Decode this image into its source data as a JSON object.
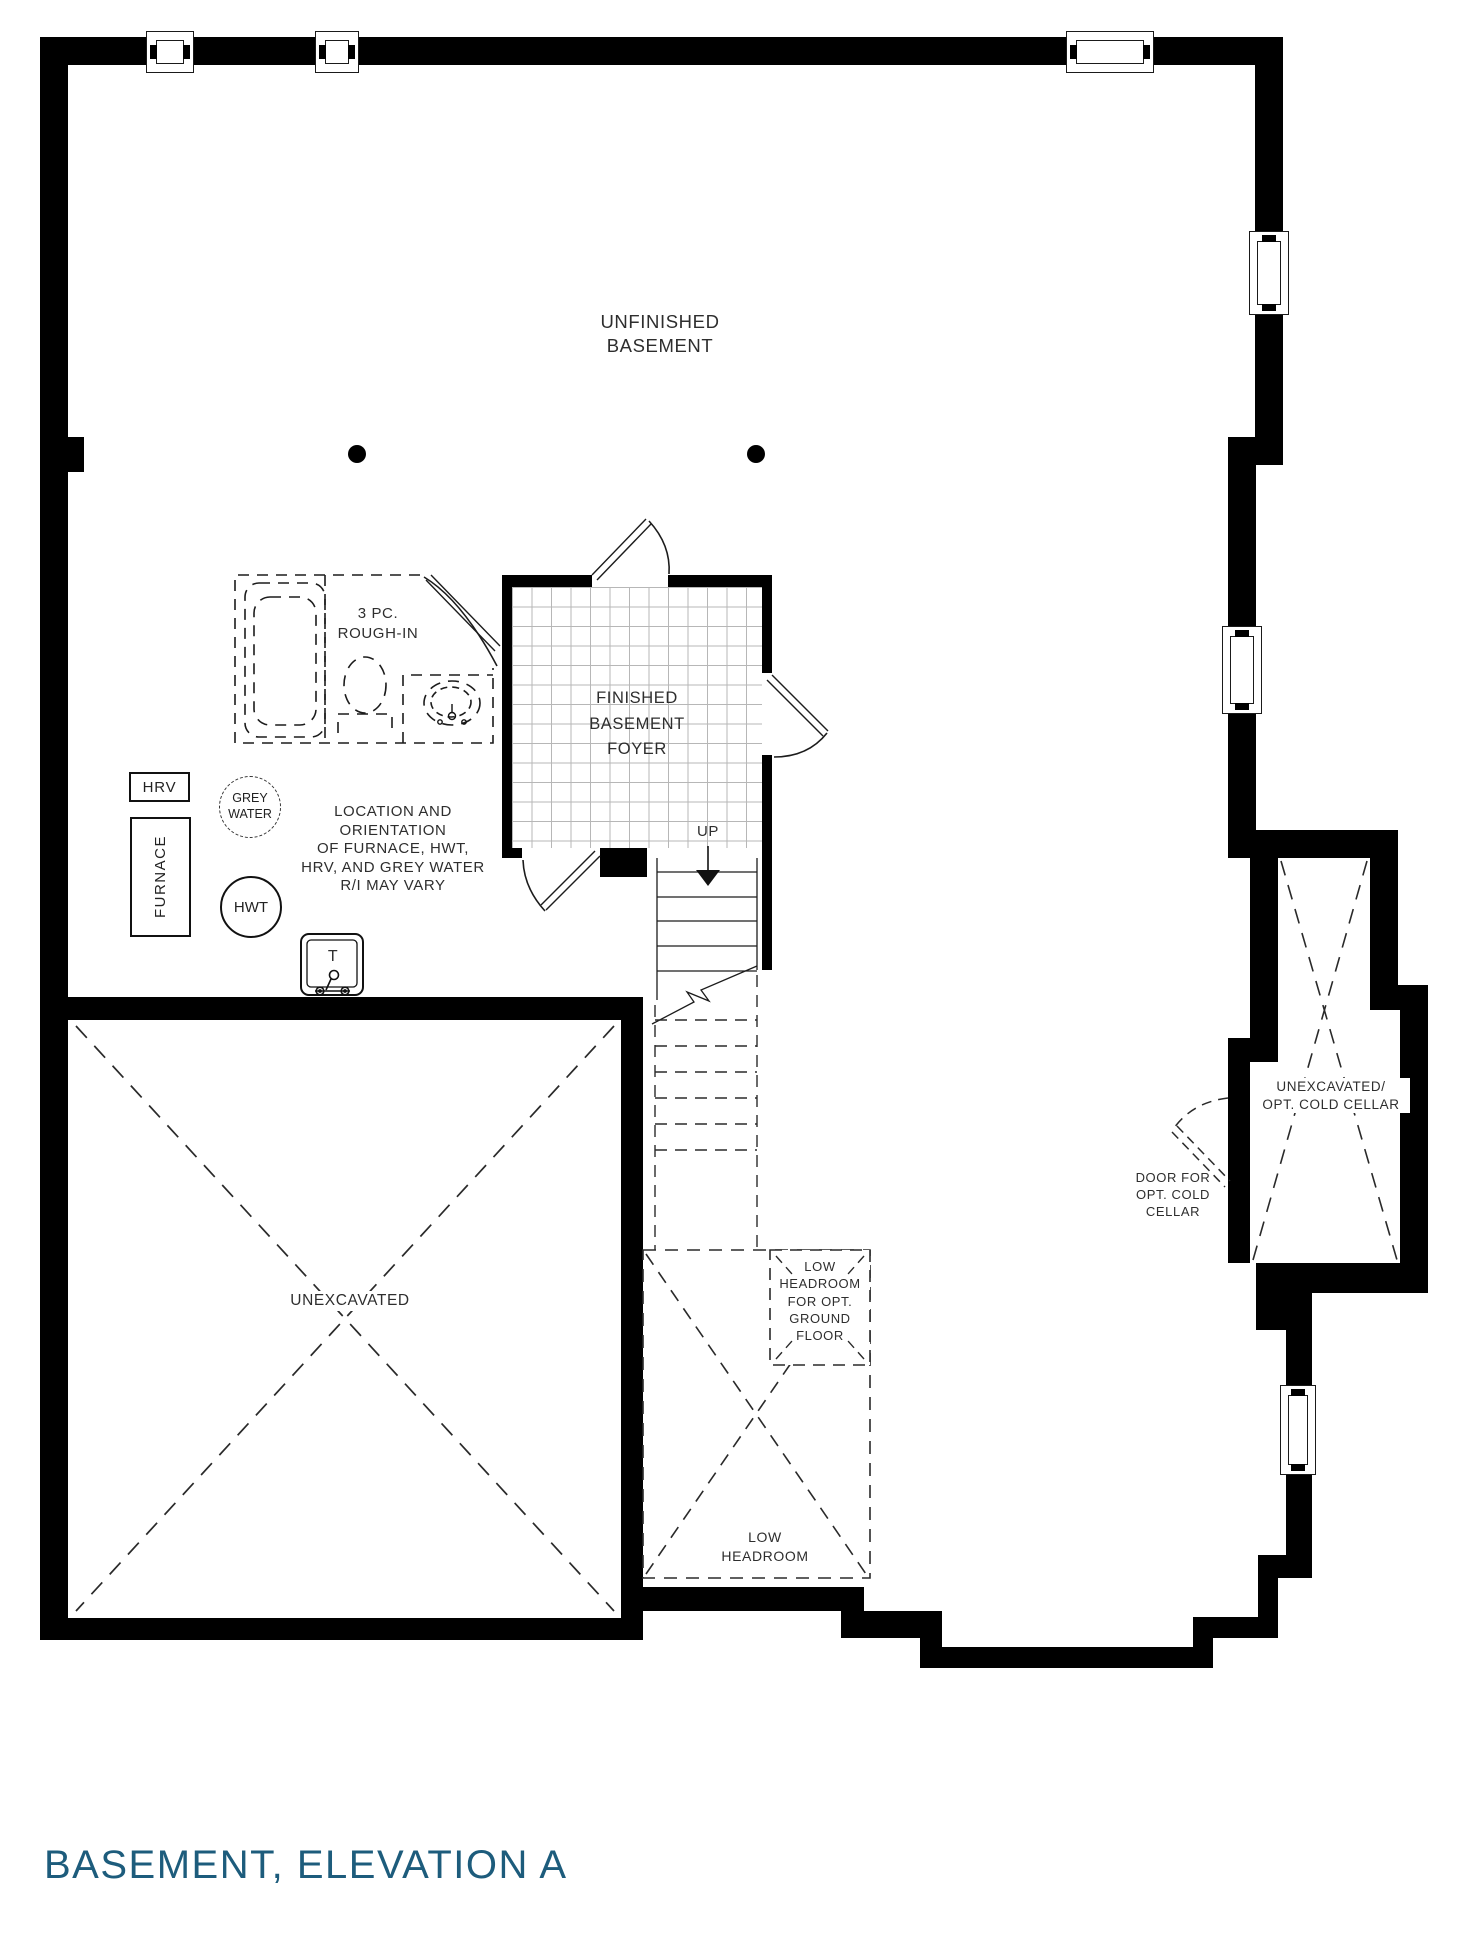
{
  "title": "BASEMENT, ELEVATION A",
  "colors": {
    "wall": "#000000",
    "text": "#2e2e2e",
    "title": "#1d5c7c",
    "tile_line": "#b7b7b7"
  },
  "rooms": {
    "unfinished_basement": {
      "line1": "UNFINISHED",
      "line2": "BASEMENT"
    },
    "foyer": {
      "line1": "FINISHED",
      "line2": "BASEMENT",
      "line3": "FOYER"
    },
    "unexcavated": {
      "label": "UNEXCAVATED"
    },
    "cold_cellar": {
      "line1": "UNEXCAVATED/",
      "line2": "OPT. COLD CELLAR"
    }
  },
  "annotations": {
    "rough_in": {
      "line1": "3 PC.",
      "line2": "ROUGH-IN"
    },
    "up": "UP",
    "hrv": "HRV",
    "furnace": "FURNACE",
    "grey_water": {
      "line1": "GREY",
      "line2": "WATER"
    },
    "hwt": "HWT",
    "tub": "T",
    "location_note": [
      "LOCATION AND",
      "ORIENTATION",
      "OF FURNACE, HWT,",
      "HRV, AND GREY WATER",
      "R/I MAY VARY"
    ],
    "cellar_door_note": [
      "DOOR FOR",
      "OPT. COLD",
      "CELLAR"
    ],
    "low_headroom_opt": [
      "LOW",
      "HEADROOM",
      "FOR OPT.",
      "GROUND",
      "FLOOR"
    ],
    "low_headroom": [
      "LOW",
      "HEADROOM"
    ]
  }
}
